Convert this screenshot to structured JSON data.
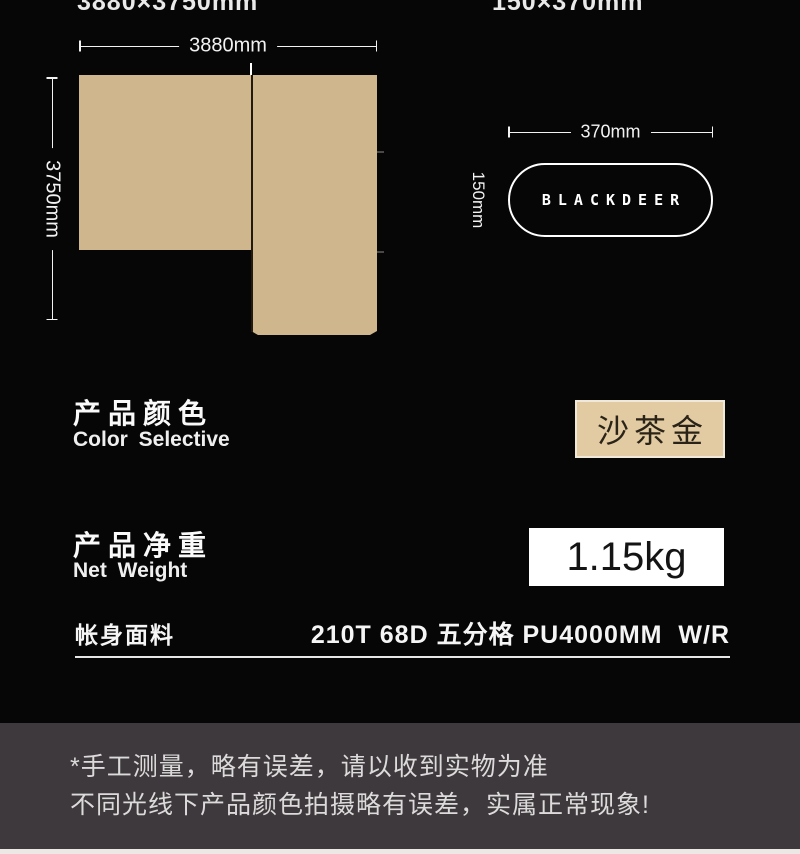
{
  "colors": {
    "background": "#060606",
    "fabric_tan": "#cfb68d",
    "swatch_fill": "#e2caa2",
    "swatch_border": "#f0e9da",
    "footer_gray": "#3d393c",
    "white": "#ffffff"
  },
  "header": {
    "left_size_label": "3880×3750mm",
    "right_size_label": "150×370mm"
  },
  "tarp_diagram": {
    "width_label": "3880mm",
    "height_label": "3750mm"
  },
  "bag_diagram": {
    "width_label": "370mm",
    "height_label": "150mm",
    "brand": "BLACKDEER"
  },
  "color_section": {
    "title_zh": "产品颜色",
    "title_en": "Color Selective",
    "swatch_label": "沙茶金"
  },
  "weight_section": {
    "title_zh": "产品净重",
    "title_en": "Net Weight",
    "value": "1.15kg"
  },
  "fabric_row": {
    "label": "帐身面料",
    "value": "210T 68D 五分格 PU4000MM  W/R"
  },
  "footer": {
    "note1": "*手工测量，略有误差，请以收到实物为准",
    "note2": "不同光线下产品颜色拍摄略有误差，实属正常现象!"
  }
}
